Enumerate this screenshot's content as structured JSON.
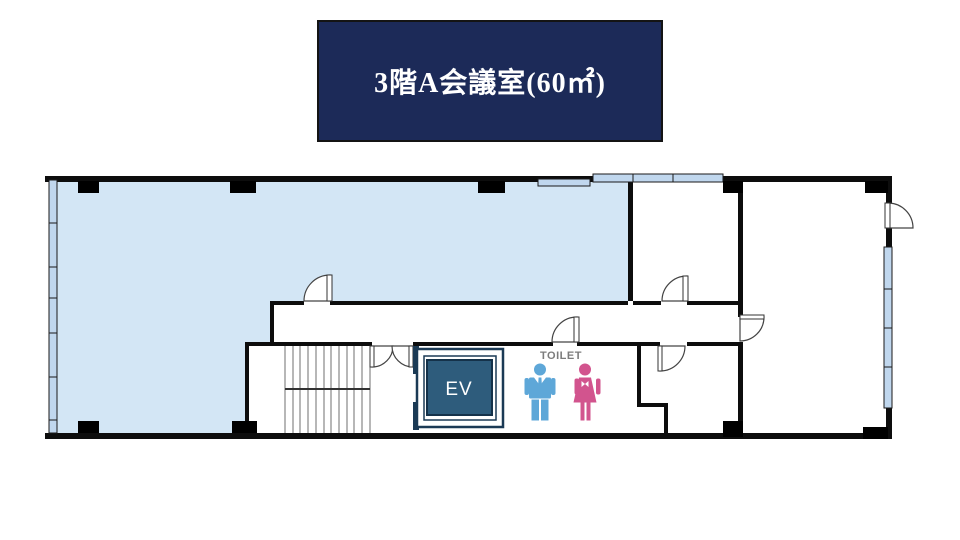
{
  "title": {
    "text": "3階A会議室(60㎡)"
  },
  "plan": {
    "elevator_label": "EV",
    "toilet_label": "TOILET",
    "meeting_room_area_sqm": "60"
  },
  "colors": {
    "title_bg": "#1c2a58",
    "title_text": "#ffffff",
    "room_fill": "#d3e6f5",
    "window_fill": "#c0d7ee",
    "wall": "#0d0d0d",
    "elevator_fill": "#2e5c7c",
    "elevator_frame": "#1b3a55",
    "elevator_text": "#ffffff",
    "male_icon": "#5ea7d8",
    "female_icon": "#d2548e",
    "toilet_text": "#7c7c7c"
  }
}
